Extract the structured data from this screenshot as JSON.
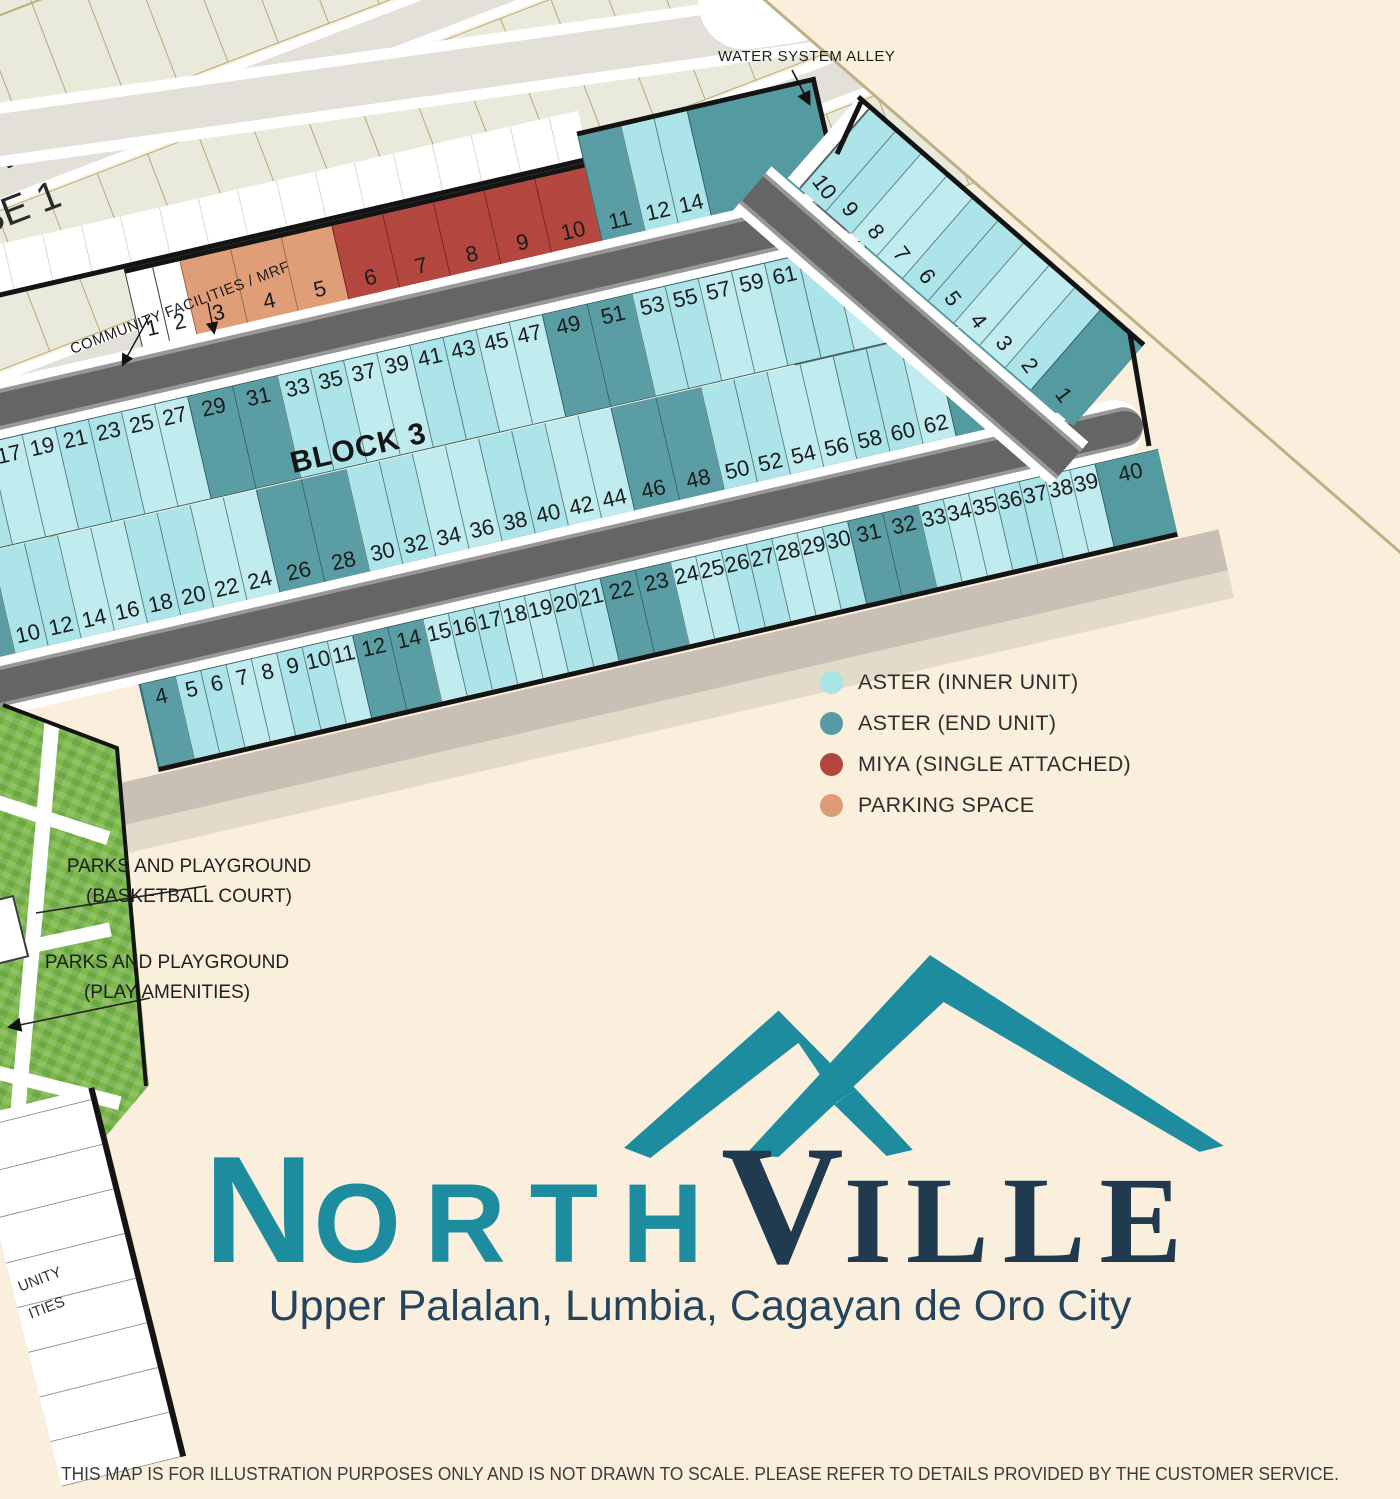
{
  "phase": {
    "name_fragment_line1": "RVILLE",
    "name_fragment_line2": "SE 1"
  },
  "labels": {
    "water_system_alley": "WATER SYSTEM ALLEY",
    "community_facilities": "COMMUNITY FACILITIES / MRF",
    "community_fragment_line1": "UNITY",
    "community_fragment_line2": "ITIES",
    "parks_basketball_line1": "PARKS AND PLAYGROUND",
    "parks_basketball_line2": "(BASKETBALL COURT)",
    "parks_play_line1": "PARKS AND PLAYGROUND",
    "parks_play_line2": "(PLAY AMENITIES)"
  },
  "legend": {
    "items": [
      {
        "label": "ASTER (INNER UNIT)",
        "color": "#a9e4e9"
      },
      {
        "label": "ASTER (END UNIT)",
        "color": "#579aa1"
      },
      {
        "label": "MIYA (SINGLE ATTACHED)",
        "color": "#b4453e"
      },
      {
        "label": "PARKING SPACE",
        "color": "#dd9b76"
      }
    ]
  },
  "blocks": {
    "block4": {
      "label": "BLOCK 4",
      "row_main": [
        {
          "n": "1",
          "t": "facility"
        },
        {
          "n": "2",
          "t": "facility"
        },
        {
          "n": "3",
          "t": "parking"
        },
        {
          "n": "4",
          "t": "parking"
        },
        {
          "n": "5",
          "t": "parking"
        },
        {
          "n": "6",
          "t": "miya"
        },
        {
          "n": "7",
          "t": "miya"
        },
        {
          "n": "8",
          "t": "miya"
        },
        {
          "n": "9",
          "t": "miya"
        },
        {
          "n": "10",
          "t": "miya"
        }
      ],
      "row_upper": [
        {
          "n": "11",
          "t": "end"
        },
        {
          "n": "12",
          "t": "inner"
        },
        {
          "n": "14",
          "t": "inner"
        },
        {
          "n": "15",
          "t": "corner"
        }
      ]
    },
    "block3": {
      "label": "BLOCK 3",
      "row_top": [
        {
          "n": "",
          "t": "cut"
        },
        {
          "n": "9",
          "t": "end"
        },
        {
          "n": "11",
          "t": "inner"
        },
        {
          "n": "15",
          "t": "inner"
        },
        {
          "n": "17",
          "t": "inner"
        },
        {
          "n": "19",
          "t": "inner"
        },
        {
          "n": "21",
          "t": "inner"
        },
        {
          "n": "23",
          "t": "inner"
        },
        {
          "n": "25",
          "t": "inner"
        },
        {
          "n": "27",
          "t": "inner"
        },
        {
          "n": "29",
          "t": "end"
        },
        {
          "n": "31",
          "t": "end"
        },
        {
          "n": "33",
          "t": "inner"
        },
        {
          "n": "35",
          "t": "inner"
        },
        {
          "n": "37",
          "t": "inner"
        },
        {
          "n": "39",
          "t": "inner"
        },
        {
          "n": "41",
          "t": "inner"
        },
        {
          "n": "43",
          "t": "inner"
        },
        {
          "n": "45",
          "t": "inner"
        },
        {
          "n": "47",
          "t": "inner"
        },
        {
          "n": "49",
          "t": "end"
        },
        {
          "n": "51",
          "t": "end"
        },
        {
          "n": "53",
          "t": "inner"
        },
        {
          "n": "55",
          "t": "inner"
        },
        {
          "n": "57",
          "t": "inner"
        },
        {
          "n": "59",
          "t": "inner"
        },
        {
          "n": "61",
          "t": "inner"
        },
        {
          "n": "63",
          "t": "inner"
        },
        {
          "n": "65",
          "t": "inner"
        },
        {
          "n": "",
          "t": "corner"
        }
      ],
      "row_bottom": [
        {
          "n": "",
          "t": "cut"
        },
        {
          "n": "6",
          "t": "end"
        },
        {
          "n": "8",
          "t": "end"
        },
        {
          "n": "10",
          "t": "inner"
        },
        {
          "n": "12",
          "t": "inner"
        },
        {
          "n": "14",
          "t": "inner"
        },
        {
          "n": "16",
          "t": "inner"
        },
        {
          "n": "18",
          "t": "inner"
        },
        {
          "n": "20",
          "t": "inner"
        },
        {
          "n": "22",
          "t": "inner"
        },
        {
          "n": "24",
          "t": "inner"
        },
        {
          "n": "26",
          "t": "end"
        },
        {
          "n": "28",
          "t": "end"
        },
        {
          "n": "30",
          "t": "inner"
        },
        {
          "n": "32",
          "t": "inner"
        },
        {
          "n": "34",
          "t": "inner"
        },
        {
          "n": "36",
          "t": "inner"
        },
        {
          "n": "38",
          "t": "inner"
        },
        {
          "n": "40",
          "t": "inner"
        },
        {
          "n": "42",
          "t": "inner"
        },
        {
          "n": "44",
          "t": "inner"
        },
        {
          "n": "46",
          "t": "end"
        },
        {
          "n": "48",
          "t": "end"
        },
        {
          "n": "50",
          "t": "inner"
        },
        {
          "n": "52",
          "t": "inner"
        },
        {
          "n": "54",
          "t": "inner"
        },
        {
          "n": "56",
          "t": "inner"
        },
        {
          "n": "58",
          "t": "inner"
        },
        {
          "n": "60",
          "t": "inner"
        },
        {
          "n": "62",
          "t": "inner"
        },
        {
          "n": "64",
          "t": "corner"
        }
      ]
    },
    "block2": {
      "label": "BLOCK 2",
      "row": [
        {
          "n": "4",
          "t": "end"
        },
        {
          "n": "5",
          "t": "inner"
        },
        {
          "n": "6",
          "t": "inner"
        },
        {
          "n": "7",
          "t": "inner"
        },
        {
          "n": "8",
          "t": "inner"
        },
        {
          "n": "9",
          "t": "inner"
        },
        {
          "n": "10",
          "t": "inner"
        },
        {
          "n": "11",
          "t": "inner"
        },
        {
          "n": "12",
          "t": "end"
        },
        {
          "n": "14",
          "t": "end"
        },
        {
          "n": "15",
          "t": "inner"
        },
        {
          "n": "16",
          "t": "inner"
        },
        {
          "n": "17",
          "t": "inner"
        },
        {
          "n": "18",
          "t": "inner"
        },
        {
          "n": "19",
          "t": "inner"
        },
        {
          "n": "20",
          "t": "inner"
        },
        {
          "n": "21",
          "t": "inner"
        },
        {
          "n": "22",
          "t": "end"
        },
        {
          "n": "23",
          "t": "end"
        },
        {
          "n": "24",
          "t": "inner"
        },
        {
          "n": "25",
          "t": "inner"
        },
        {
          "n": "26",
          "t": "inner"
        },
        {
          "n": "27",
          "t": "inner"
        },
        {
          "n": "28",
          "t": "inner"
        },
        {
          "n": "29",
          "t": "inner"
        },
        {
          "n": "30",
          "t": "inner"
        },
        {
          "n": "31",
          "t": "end"
        },
        {
          "n": "32",
          "t": "end"
        },
        {
          "n": "33",
          "t": "inner"
        },
        {
          "n": "34",
          "t": "inner"
        },
        {
          "n": "35",
          "t": "inner"
        },
        {
          "n": "36",
          "t": "inner"
        },
        {
          "n": "37",
          "t": "inner"
        },
        {
          "n": "38",
          "t": "inner"
        },
        {
          "n": "39",
          "t": "inner"
        },
        {
          "n": "40",
          "t": "corner"
        }
      ]
    },
    "block5": {
      "label": "BLOCK 5",
      "row": [
        {
          "n": "",
          "t": "alley"
        },
        {
          "n": "10",
          "t": "inner"
        },
        {
          "n": "9",
          "t": "inner"
        },
        {
          "n": "8",
          "t": "inner"
        },
        {
          "n": "7",
          "t": "inner"
        },
        {
          "n": "6",
          "t": "inner"
        },
        {
          "n": "5",
          "t": "inner"
        },
        {
          "n": "4",
          "t": "inner"
        },
        {
          "n": "3",
          "t": "inner"
        },
        {
          "n": "2",
          "t": "inner"
        },
        {
          "n": "1",
          "t": "corner"
        }
      ]
    }
  },
  "logo": {
    "name_part1": "N",
    "name_part2": "ORTH",
    "name_part3": "V",
    "name_part4": "ILLE",
    "tagline": "Upper Palalan, Lumbia, Cagayan de Oro City"
  },
  "footer": {
    "disclaimer": "THIS MAP IS FOR ILLUSTRATION PURPOSES ONLY AND IS NOT DRAWN TO SCALE. PLEASE REFER TO DETAILS PROVIDED BY THE CUSTOMER SERVICE."
  },
  "colors": {
    "background": "#f9efdc",
    "aster_inner": "#ade4e9",
    "aster_end": "#5a9da4",
    "miya": "#b4473f",
    "parking": "#df9e78",
    "road": "#656565",
    "boundary": "#141414",
    "logo_teal": "#1d8c9e",
    "logo_navy": "#203a50"
  }
}
